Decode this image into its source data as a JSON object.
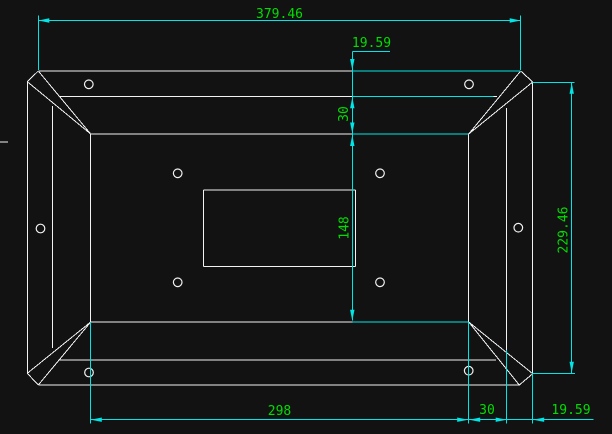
{
  "app": {
    "name": "cad-drawing-viewport"
  },
  "colors": {
    "background": "#121212",
    "geometry": "#f2f2f2",
    "dimension": "#00e5e5",
    "label": "#00dd00"
  },
  "dimensions": {
    "total_width": {
      "text": "379.46"
    },
    "top_offset": {
      "text": "19.59"
    },
    "top_band": {
      "text": "30"
    },
    "opening_height": {
      "text": "148"
    },
    "total_height": {
      "text": "229.46"
    },
    "opening_width": {
      "text": "298"
    },
    "bottom_band": {
      "text": "30"
    },
    "bottom_offset": {
      "text": "19.59"
    }
  },
  "geometry": {
    "outline_segments": [
      [
        "outer-top-edge",
        38.3,
        71,
        520.7,
        71
      ],
      [
        "outer-bottom-edge",
        38.3,
        385,
        519.3,
        385
      ],
      [
        "outer-left-edge",
        27.3,
        81.7,
        27.3,
        373.3
      ],
      [
        "outer-right-edge",
        532.7,
        82,
        532.7,
        373.7
      ],
      [
        "chamfer-top-left",
        38.3,
        71,
        27.3,
        81.7
      ],
      [
        "chamfer-top-right",
        520.7,
        71,
        532.7,
        82
      ],
      [
        "chamfer-bottom-left",
        27.3,
        373.3,
        38.3,
        385
      ],
      [
        "chamfer-bottom-right",
        519.3,
        385,
        532.7,
        373.7
      ],
      [
        "frame-top-edge",
        60,
        96.7,
        497,
        96.7
      ],
      [
        "frame-bottom-edge",
        59,
        360,
        496,
        360
      ],
      [
        "frame-left-edge",
        52.7,
        106,
        52.7,
        348
      ],
      [
        "frame-right-edge",
        506.7,
        108,
        506.7,
        350
      ],
      [
        "opening-top-edge",
        90.7,
        134,
        468.7,
        134
      ],
      [
        "opening-bottom-edge",
        90.7,
        322,
        468.7,
        322
      ],
      [
        "opening-left-edge",
        90.7,
        134,
        90.7,
        322
      ],
      [
        "opening-right-edge",
        468.7,
        134,
        468.7,
        322
      ],
      [
        "miter-top-left-a",
        38.3,
        71,
        90.7,
        134
      ],
      [
        "miter-top-left-b",
        27.3,
        81.7,
        90.7,
        134
      ],
      [
        "miter-top-right-a",
        520.7,
        71,
        468.7,
        134
      ],
      [
        "miter-top-right-b",
        532.7,
        82,
        468.7,
        134
      ],
      [
        "miter-bottom-left-a",
        38.3,
        385,
        90.7,
        322
      ],
      [
        "miter-bottom-left-b",
        27.3,
        373.3,
        90.7,
        322
      ],
      [
        "miter-bottom-right-a",
        519.3,
        385,
        468.7,
        322
      ],
      [
        "miter-bottom-right-b",
        532.7,
        373.7,
        468.7,
        322
      ],
      [
        "cutout-top-edge",
        203.3,
        190,
        355.7,
        190
      ],
      [
        "cutout-bottom-edge",
        203.3,
        266.7,
        355.7,
        266.7
      ],
      [
        "cutout-left-edge",
        203.3,
        190,
        203.3,
        266.7
      ],
      [
        "cutout-right-edge",
        355.7,
        190,
        355.7,
        266.7
      ],
      [
        "edge-tick-left",
        0,
        142,
        8,
        142
      ]
    ],
    "circles": [
      [
        "hole-top-left",
        88.8,
        84.3
      ],
      [
        "hole-top-right",
        469,
        84.3
      ],
      [
        "hole-mid-left",
        40.5,
        228.5
      ],
      [
        "hole-mid-right",
        518.3,
        227.7
      ],
      [
        "hole-inner-top-left",
        177.7,
        173.3
      ],
      [
        "hole-inner-top-right",
        380,
        173.3
      ],
      [
        "hole-inner-bottom-left",
        177.7,
        282.3
      ],
      [
        "hole-inner-bottom-right",
        380,
        282.3
      ],
      [
        "hole-bottom-left",
        89,
        372.5
      ],
      [
        "hole-bottom-right",
        468.7,
        370.7
      ]
    ],
    "hole_radius": 4.3,
    "dimension_segments": [
      [
        "dim-width-line",
        38.3,
        20.5,
        520.7,
        20.5
      ],
      [
        "dim-width-ext-left",
        38.3,
        15.5,
        38.3,
        70
      ],
      [
        "dim-width-ext-right",
        520.7,
        15.5,
        520.7,
        70
      ],
      [
        "dim-top-offset-landing",
        352.3,
        51.3,
        390,
        51.3
      ],
      [
        "dim-vertical-chain-line",
        352.3,
        51.3,
        352.3,
        320.7
      ],
      [
        "ext-overlay-outer-top",
        352.3,
        71,
        520.7,
        71
      ],
      [
        "ext-overlay-frame-top",
        352.3,
        96.7,
        493.7,
        96.7
      ],
      [
        "ext-overlay-opening-top",
        352.3,
        134,
        468.7,
        134
      ],
      [
        "ext-overlay-opening-bottom",
        352.3,
        322,
        468.7,
        322
      ],
      [
        "dim-height-ext-top",
        532.7,
        82.3,
        574.3,
        82.3
      ],
      [
        "dim-height-ext-bottom",
        532.7,
        373.3,
        575,
        373.3
      ],
      [
        "dim-height-line",
        571.7,
        82.3,
        571.7,
        373.3
      ],
      [
        "dim-bottom-line",
        90.3,
        419.7,
        593.3,
        419.7
      ],
      [
        "dim-bottom-ext-opening-left",
        90.3,
        322,
        90.3,
        423.5
      ],
      [
        "dim-bottom-ext-opening-right",
        468.7,
        322,
        468.7,
        423.5
      ],
      [
        "dim-bottom-ext-frame-right",
        506.7,
        350,
        506.7,
        423.5
      ],
      [
        "dim-bottom-ext-outer-right",
        532.7,
        373.3,
        532.7,
        423.5
      ]
    ],
    "arrows": [
      [
        "arrow-width-left",
        38.3,
        20.5,
        "left"
      ],
      [
        "arrow-width-right",
        520.7,
        20.5,
        "right"
      ],
      [
        "arrow-top-offset-down",
        352.3,
        70,
        "down"
      ],
      [
        "arrow-top-band-up",
        352.3,
        97.3,
        "up"
      ],
      [
        "arrow-top-band-down",
        352.3,
        133.5,
        "down"
      ],
      [
        "arrow-opening-height-up",
        352.3,
        135,
        "up"
      ],
      [
        "arrow-opening-height-down",
        352.3,
        320.7,
        "down"
      ],
      [
        "arrow-height-up",
        571.7,
        82.8,
        "up"
      ],
      [
        "arrow-height-down",
        571.7,
        372.8,
        "down"
      ],
      [
        "arrow-opening-width-left",
        90.8,
        419.7,
        "left"
      ],
      [
        "arrow-opening-width-right",
        468.2,
        419.7,
        "right"
      ],
      [
        "arrow-bottom-band-left",
        469.2,
        419.7,
        "left"
      ],
      [
        "arrow-bottom-band-right",
        506.7,
        419.7,
        "right"
      ],
      [
        "arrow-bottom-offset-left",
        533.2,
        419.7,
        "left"
      ]
    ]
  }
}
